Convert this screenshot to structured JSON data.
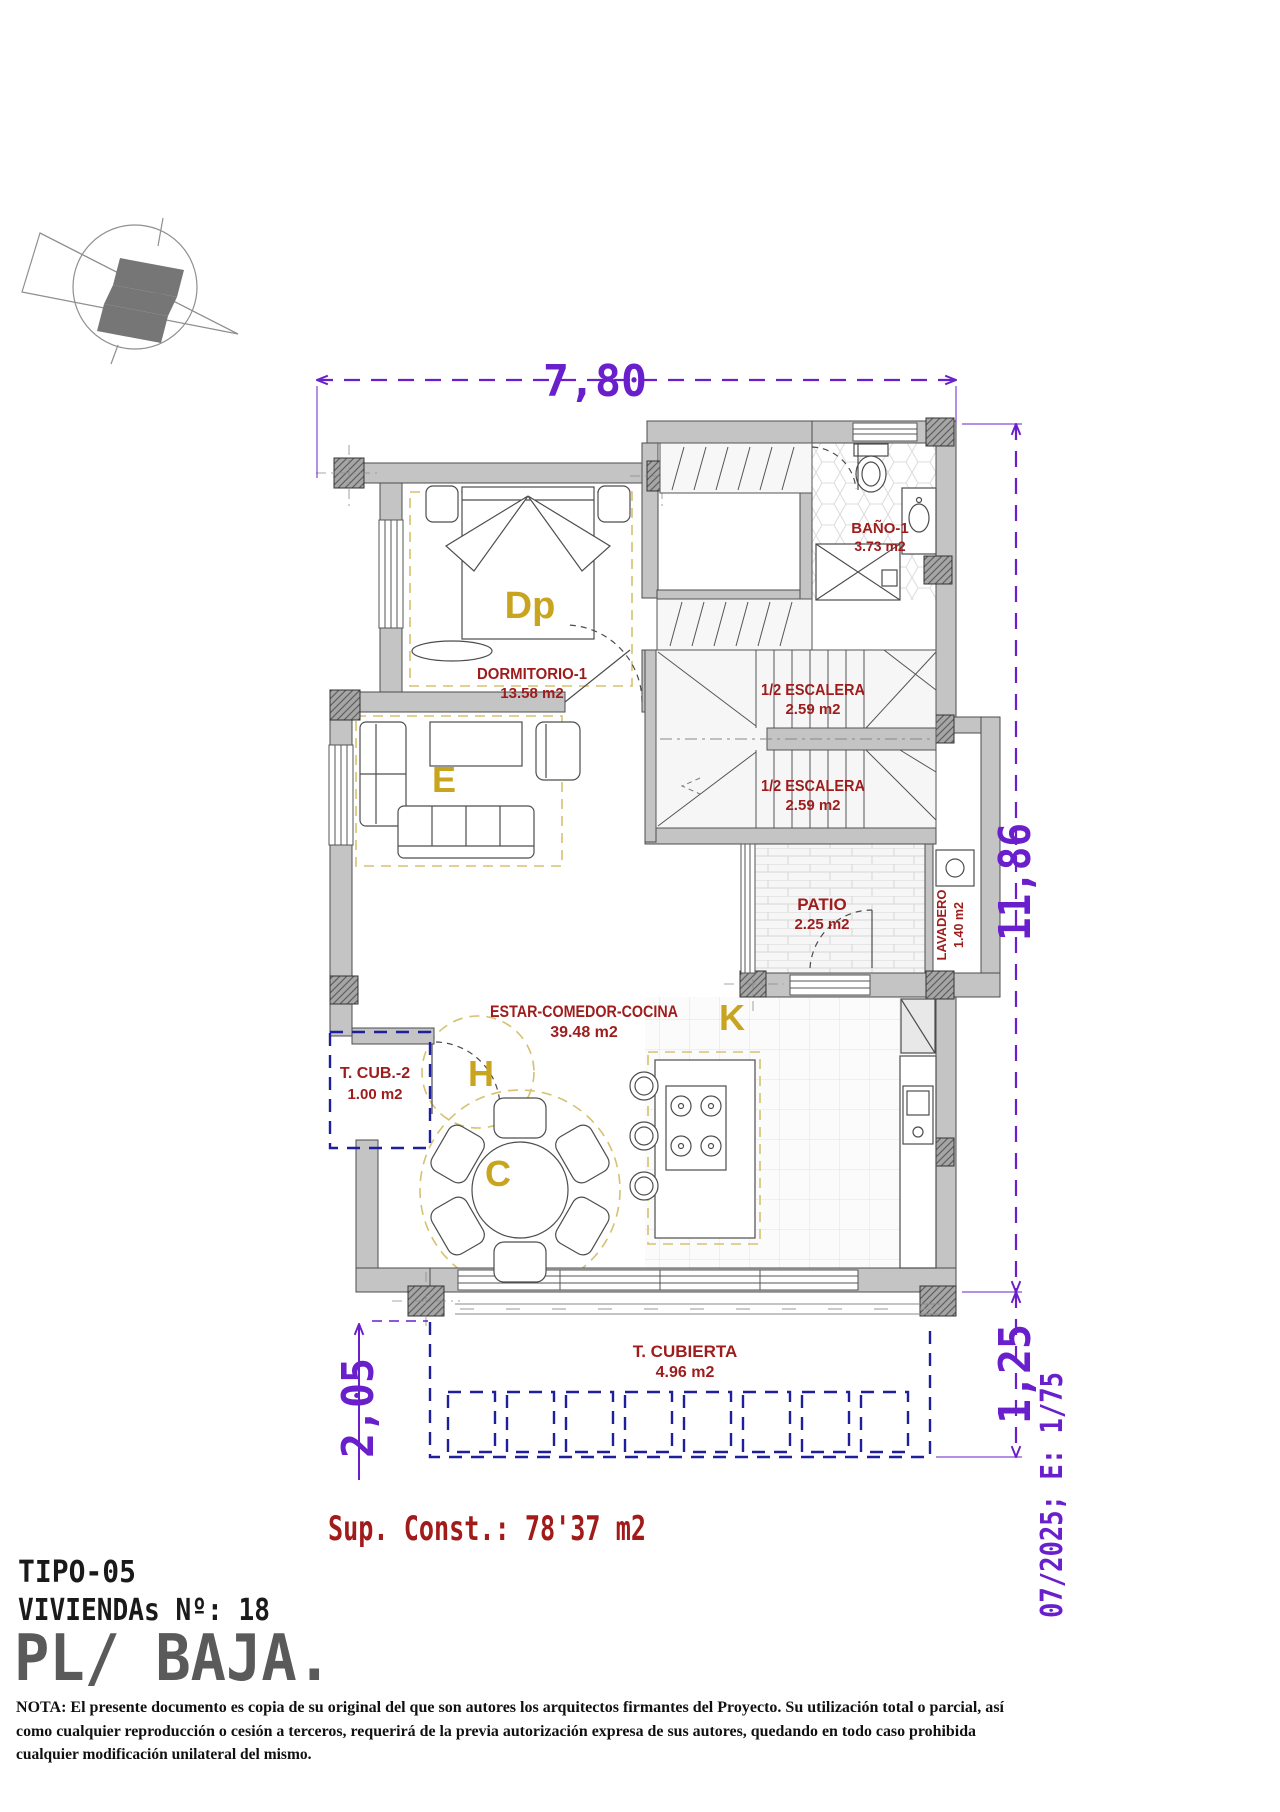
{
  "colors": {
    "label_red": "#9e1c1c",
    "zone_gold": "#c8a41f",
    "dimension_purple": "#6a1fcc",
    "terrace_navy": "#1f1f9c",
    "zone_dash_yellow": "#d6c171",
    "wall_gray": "#c4c4c4"
  },
  "dimensions": {
    "top": "7,80",
    "right": "11,86",
    "bottom_left": "2,05",
    "bottom_right": "1,25"
  },
  "rooms": {
    "dormitorio": {
      "label": "DORMITORIO-1",
      "area": "13.58 m2",
      "zone": "Dp"
    },
    "bano": {
      "label": "BAÑO-1",
      "area": "3.73 m2"
    },
    "escalera_sup": {
      "label": "1/2 ESCALERA",
      "area": "2.59 m2"
    },
    "escalera_inf": {
      "label": "1/2 ESCALERA",
      "area": "2.59 m2"
    },
    "patio": {
      "label": "PATIO",
      "area": "2.25 m2"
    },
    "lavadero": {
      "label": "LAVADERO",
      "area": "1.40 m2"
    },
    "estar": {
      "label": "ESTAR-COMEDOR-COCINA",
      "area": "39.48 m2",
      "zone_estar": "E",
      "zone_hall": "H",
      "zone_comedor": "C",
      "zone_cocina": "K"
    },
    "terraza_cub2": {
      "label": "T. CUB.-2",
      "area": "1.00 m2"
    },
    "terraza_cubierta": {
      "label": "T. CUBIERTA",
      "area": "4.96 m2"
    }
  },
  "summary": {
    "sup_const": "Sup. Const.: 78'37 m2"
  },
  "title_block": {
    "tipo": "TIPO-05",
    "viviendas": "VIVIENDAs Nº: 18",
    "planta": "PL/ BAJA."
  },
  "margin": {
    "date_scale": "07/2025; E: 1/75"
  },
  "footer": {
    "nota_line1": "NOTA: El presente documento es copia de su original del que son autores los arquitectos firmantes del Proyecto. Su utilización total o parcial, así",
    "nota_line2": "como cualquier reproducción o cesión a terceros, requerirá  de la previa autorización expresa de sus autores, quedando en todo caso prohibida",
    "nota_line3": "cualquier modificación unilateral del mismo."
  }
}
